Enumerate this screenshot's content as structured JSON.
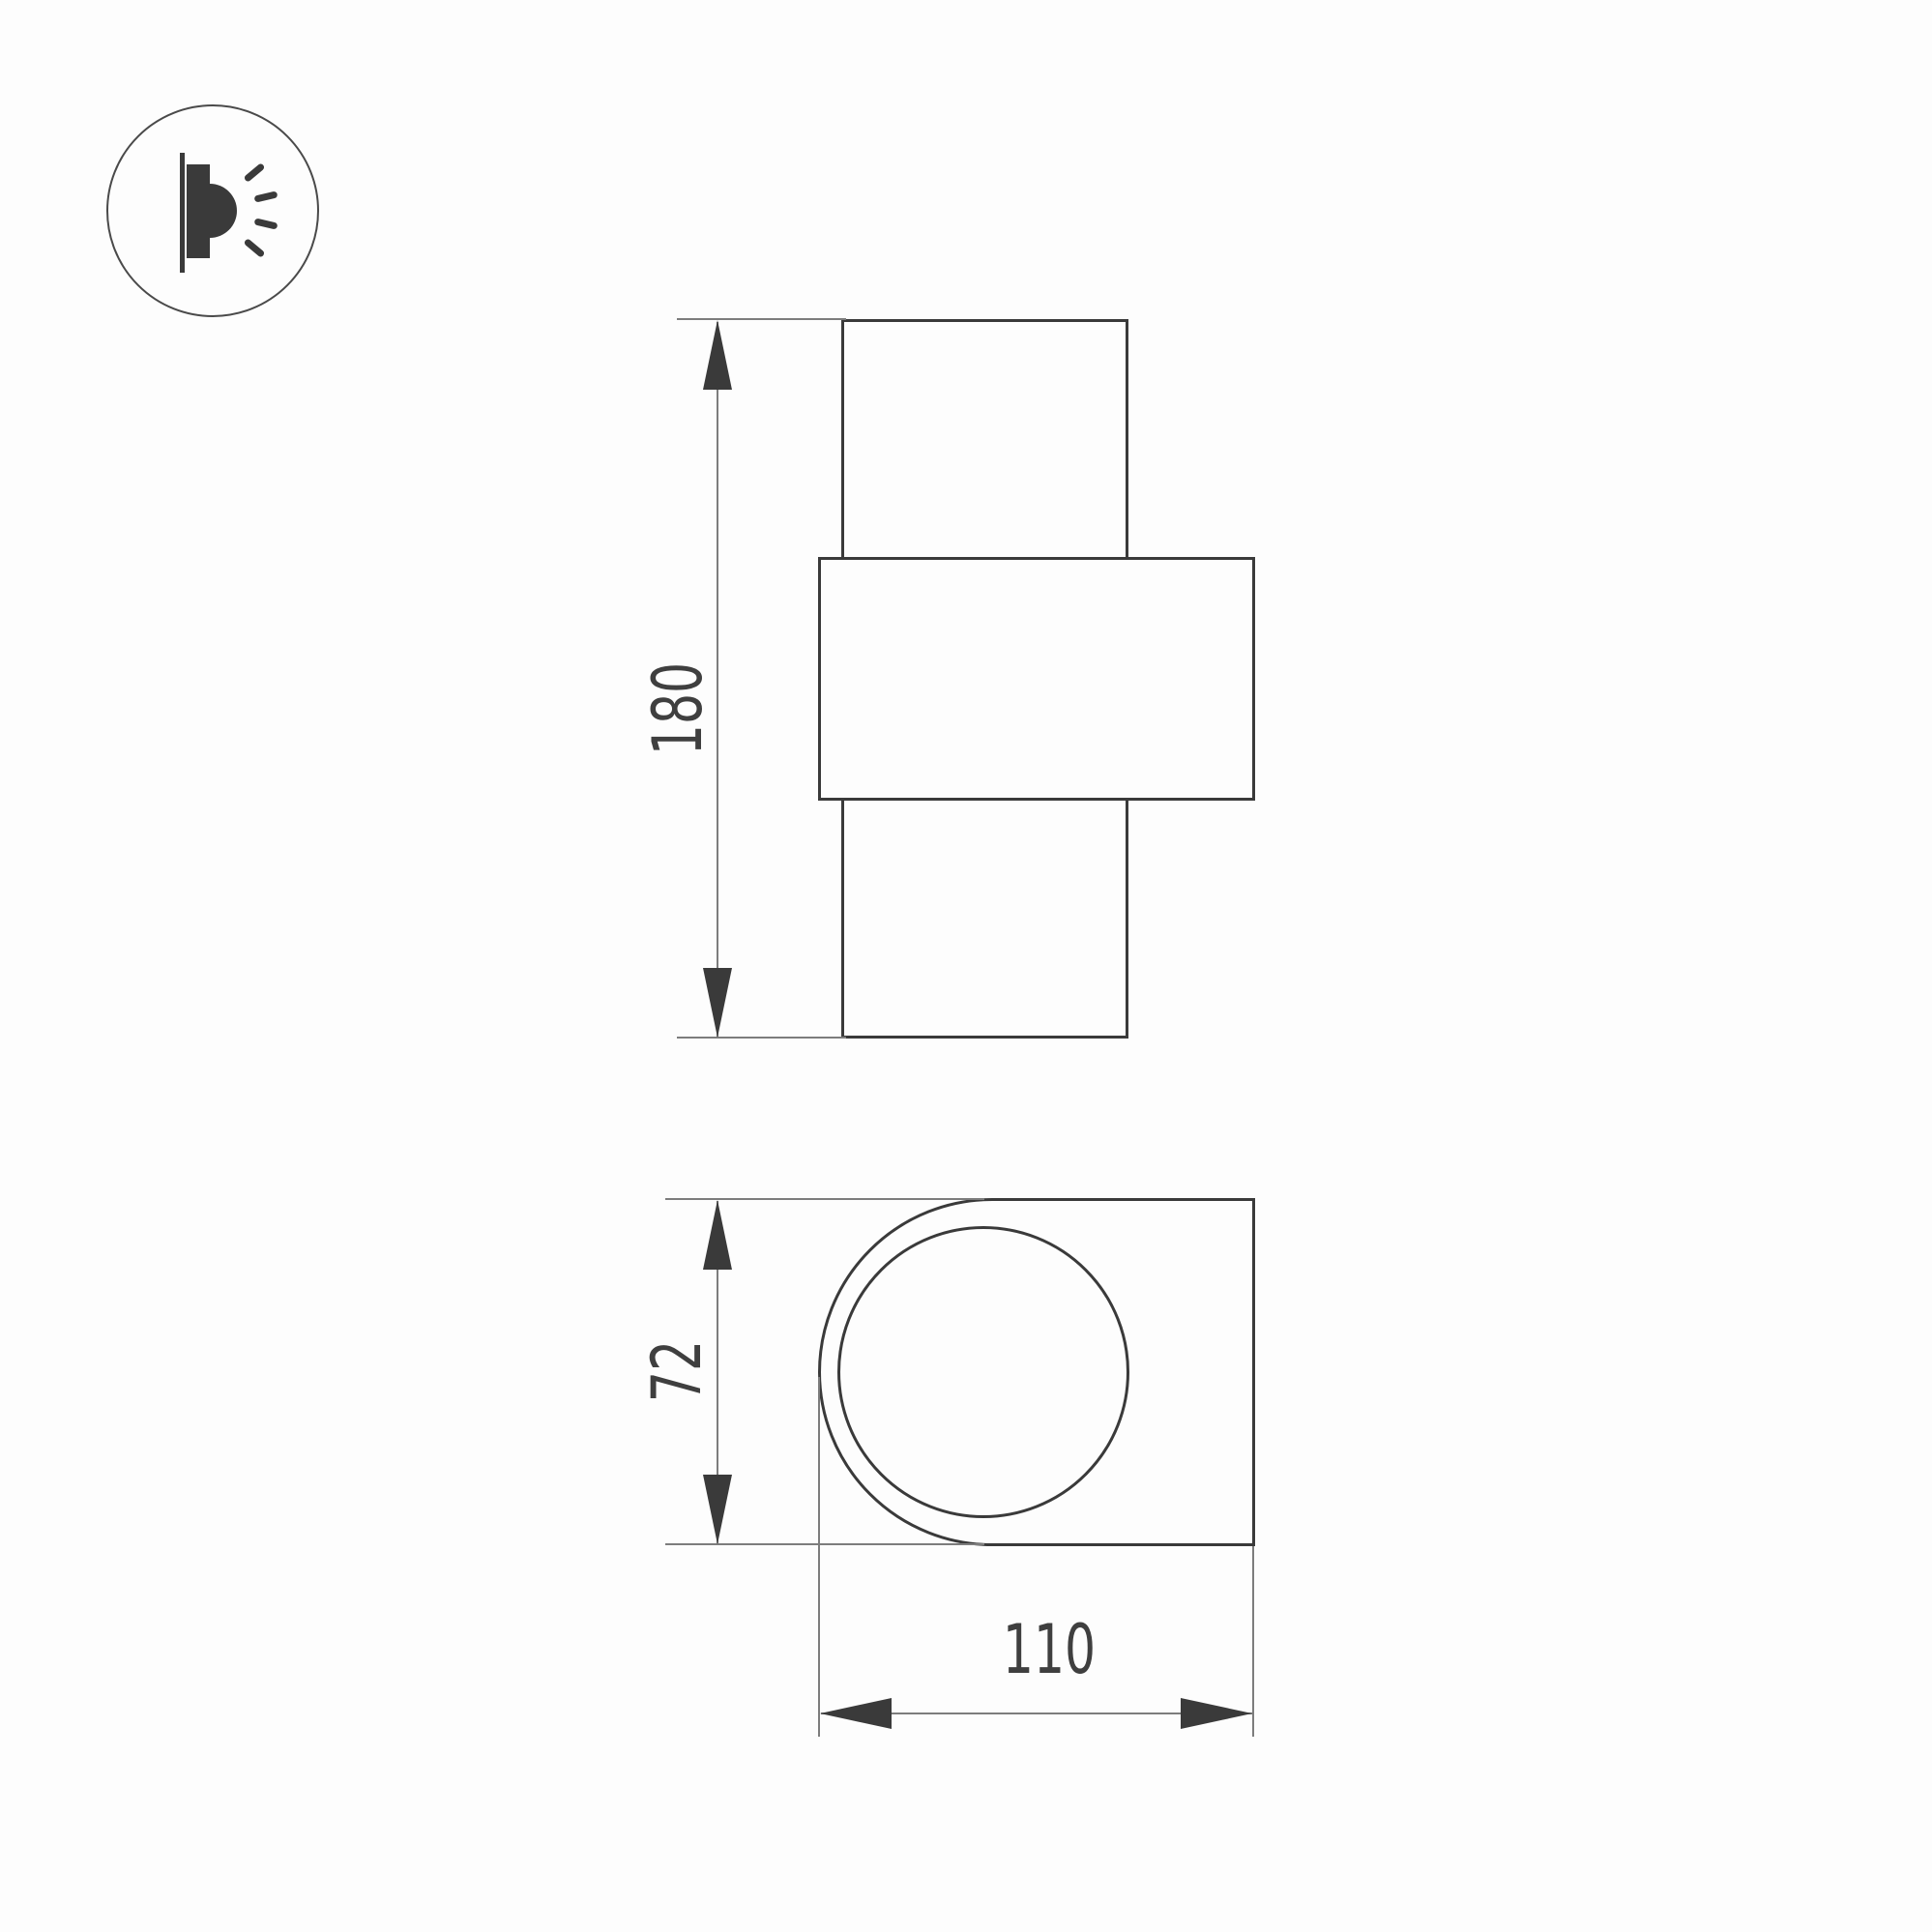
{
  "page": {
    "background": "#fdfdfd"
  },
  "drawing": {
    "type": "technical-dimension-drawing",
    "colors": {
      "outline": "#3a3a3a",
      "thin_line": "#7d7d7d",
      "label_text": "#3f3f3f"
    },
    "icon": {
      "name": "wall-lamp-side-glow-icon"
    },
    "views": {
      "front": {
        "height_label": "180"
      },
      "side": {
        "height_label": "72",
        "width_label": "110"
      }
    }
  }
}
